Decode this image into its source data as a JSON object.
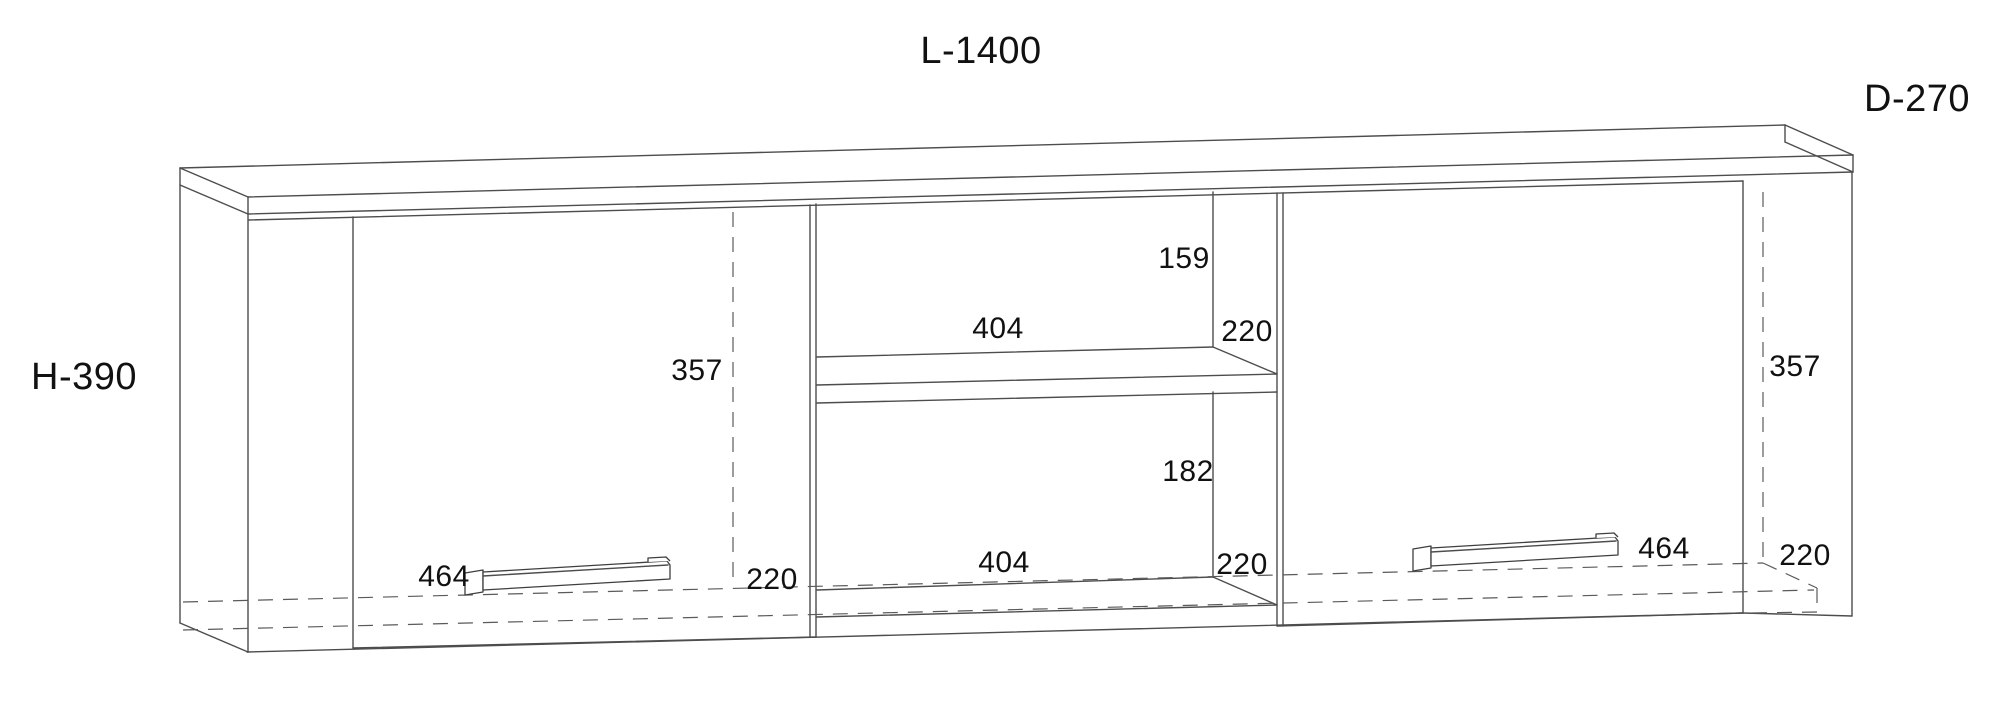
{
  "drawing_title": "wall-cabinet-dimension-drawing",
  "overall_dimensions": {
    "length": "L-1400",
    "depth": "D-270",
    "height": "H-390"
  },
  "internal_dimensions": {
    "upper_clearance": "159",
    "shelf_width": "404",
    "shelf_depth": "220",
    "door_left_height": "357",
    "door_right_height": "357",
    "lower_clearance": "182",
    "bottom_opening_width": "404",
    "bottom_opening_depth": "220",
    "handle_left_width": "464",
    "door_left_bottom_depth": "220",
    "handle_right_width": "464",
    "door_right_bottom_depth": "220"
  },
  "line_colors": {
    "solid_edge": "#4d4d4d",
    "hidden_edge_dashed": "#5a5a5a",
    "label_text": "#111111"
  }
}
